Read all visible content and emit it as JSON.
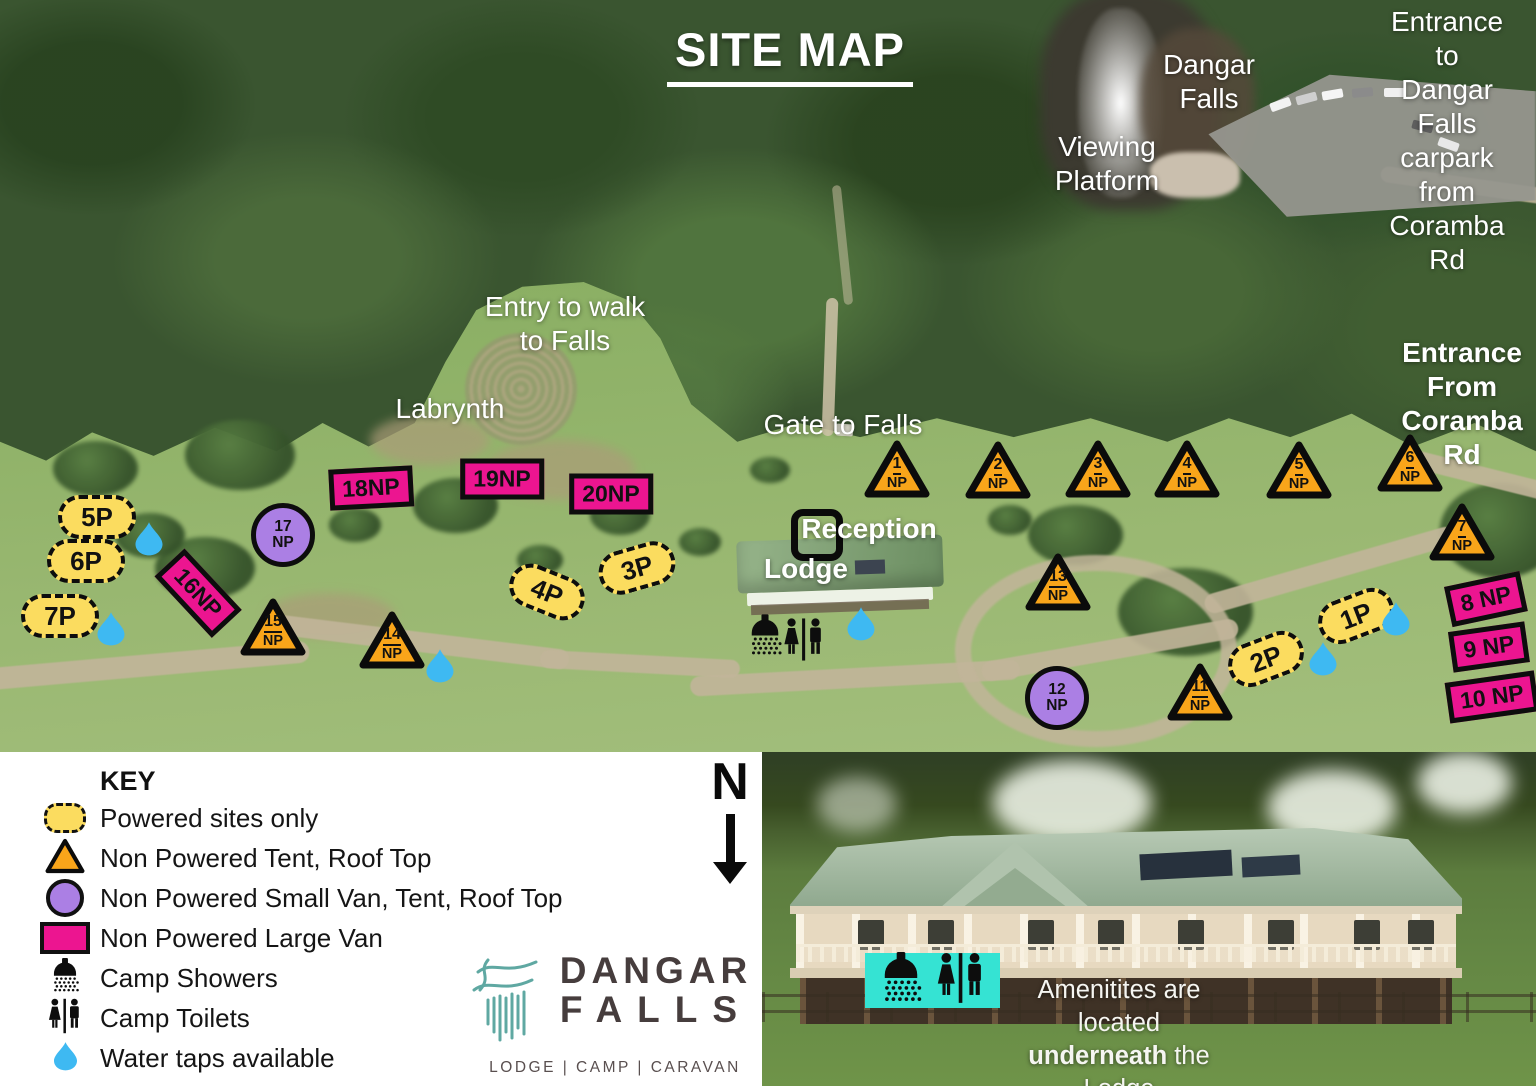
{
  "title": "SITE MAP",
  "colors": {
    "powered_yellow": "#FBDC5F",
    "np_orange": "#F9A51A",
    "small_van_purple": "#AB7FE4",
    "large_van_pink": "#EC1590",
    "water_blue": "#3EB9F2",
    "amenities_cyan": "#35E3D3",
    "logo_teal": "#5FA8A2",
    "logo_text": "#463D3D"
  },
  "map": {
    "np_suffix": "NP",
    "labels": [
      {
        "name": "dangar-falls",
        "text": "Dangar\nFalls",
        "x": 1209,
        "y": 48,
        "bold": false
      },
      {
        "name": "viewing-platform",
        "text": "Viewing\nPlatform",
        "x": 1107,
        "y": 130,
        "bold": false
      },
      {
        "name": "entrance-to-carpark",
        "text": "Entrance to\nDangar Falls\ncarpark from\nCoramba Rd",
        "x": 1447,
        "y": 5,
        "bold": false
      },
      {
        "name": "entry-to-walk",
        "text": "Entry to walk\nto Falls",
        "x": 565,
        "y": 290,
        "bold": false
      },
      {
        "name": "labrynth",
        "text": "Labrynth",
        "x": 450,
        "y": 392,
        "bold": false
      },
      {
        "name": "gate-to-falls",
        "text": "Gate to Falls",
        "x": 843,
        "y": 408,
        "bold": false
      },
      {
        "name": "entrance-from-coramba",
        "text": "Entrance\nFrom\nCoramba Rd",
        "x": 1462,
        "y": 336,
        "bold": true
      },
      {
        "name": "reception",
        "text": "Reception",
        "x": 869,
        "y": 512,
        "bold": true
      },
      {
        "name": "lodge",
        "text": "Lodge",
        "x": 806,
        "y": 552,
        "bold": true
      }
    ],
    "powered_sites": [
      {
        "label": "5P",
        "x": 97,
        "y": 517,
        "rot": 0
      },
      {
        "label": "6P",
        "x": 86,
        "y": 561,
        "rot": 0
      },
      {
        "label": "7P",
        "x": 60,
        "y": 616,
        "rot": 0
      },
      {
        "label": "4P",
        "x": 547,
        "y": 592,
        "rot": 22
      },
      {
        "label": "3P",
        "x": 637,
        "y": 568,
        "rot": -16
      },
      {
        "label": "2P",
        "x": 1266,
        "y": 659,
        "rot": -21
      },
      {
        "label": "1P",
        "x": 1356,
        "y": 616,
        "rot": -21
      }
    ],
    "tent_sites": [
      {
        "num": "1",
        "x": 897,
        "y": 469
      },
      {
        "num": "2",
        "x": 998,
        "y": 470
      },
      {
        "num": "3",
        "x": 1098,
        "y": 469
      },
      {
        "num": "4",
        "x": 1187,
        "y": 469
      },
      {
        "num": "5",
        "x": 1299,
        "y": 470
      },
      {
        "num": "6",
        "x": 1410,
        "y": 463
      },
      {
        "num": "7",
        "x": 1462,
        "y": 532
      },
      {
        "num": "13",
        "x": 1058,
        "y": 582
      },
      {
        "num": "15",
        "x": 273,
        "y": 627
      },
      {
        "num": "14",
        "x": 392,
        "y": 640
      },
      {
        "num": "11",
        "x": 1200,
        "y": 692
      }
    ],
    "small_van_sites": [
      {
        "num": "17",
        "x": 283,
        "y": 535
      },
      {
        "num": "12",
        "x": 1057,
        "y": 698
      }
    ],
    "large_van_sites": [
      {
        "label": "18NP",
        "x": 371,
        "y": 488,
        "rot": -3
      },
      {
        "label": "19NP",
        "x": 502,
        "y": 479,
        "rot": 0
      },
      {
        "label": "20NP",
        "x": 611,
        "y": 494,
        "rot": 0
      },
      {
        "label": "16NP",
        "x": 198,
        "y": 593,
        "rot": 47
      },
      {
        "label": "8 NP",
        "x": 1486,
        "y": 599,
        "rot": -12
      },
      {
        "label": "9 NP",
        "x": 1489,
        "y": 647,
        "rot": -8
      },
      {
        "label": "10 NP",
        "x": 1492,
        "y": 697,
        "rot": -8
      }
    ],
    "water_taps": [
      {
        "x": 149,
        "y": 541
      },
      {
        "x": 111,
        "y": 631
      },
      {
        "x": 440,
        "y": 668
      },
      {
        "x": 861,
        "y": 626
      },
      {
        "x": 1323,
        "y": 661
      },
      {
        "x": 1396,
        "y": 621
      }
    ],
    "amenity_icons": {
      "shower": {
        "x": 765,
        "y": 638
      },
      "toilets": {
        "x": 804,
        "y": 642
      }
    }
  },
  "key": {
    "heading": "KEY",
    "items": [
      {
        "icon": "powered-oval",
        "label": "Powered sites only"
      },
      {
        "icon": "tent-triangle",
        "label": "Non Powered Tent, Roof Top"
      },
      {
        "icon": "small-van-circle",
        "label": "Non Powered Small Van, Tent, Roof Top"
      },
      {
        "icon": "large-van-rect",
        "label": "Non Powered Large Van"
      },
      {
        "icon": "camp-shower",
        "label": "Camp Showers"
      },
      {
        "icon": "camp-toilets",
        "label": "Camp Toilets"
      },
      {
        "icon": "water-drop",
        "label": "Water taps available"
      }
    ]
  },
  "compass": {
    "letter": "N"
  },
  "logo": {
    "name_line1": "DANGAR",
    "name_line2": "FALLS",
    "tagline": "LODGE | CAMP | CARAVAN"
  },
  "inset": {
    "line1": "Amenitites are located",
    "line2_bold": "underneath",
    "line2_rest": " the Lodge",
    "line3": "deck to the North"
  }
}
